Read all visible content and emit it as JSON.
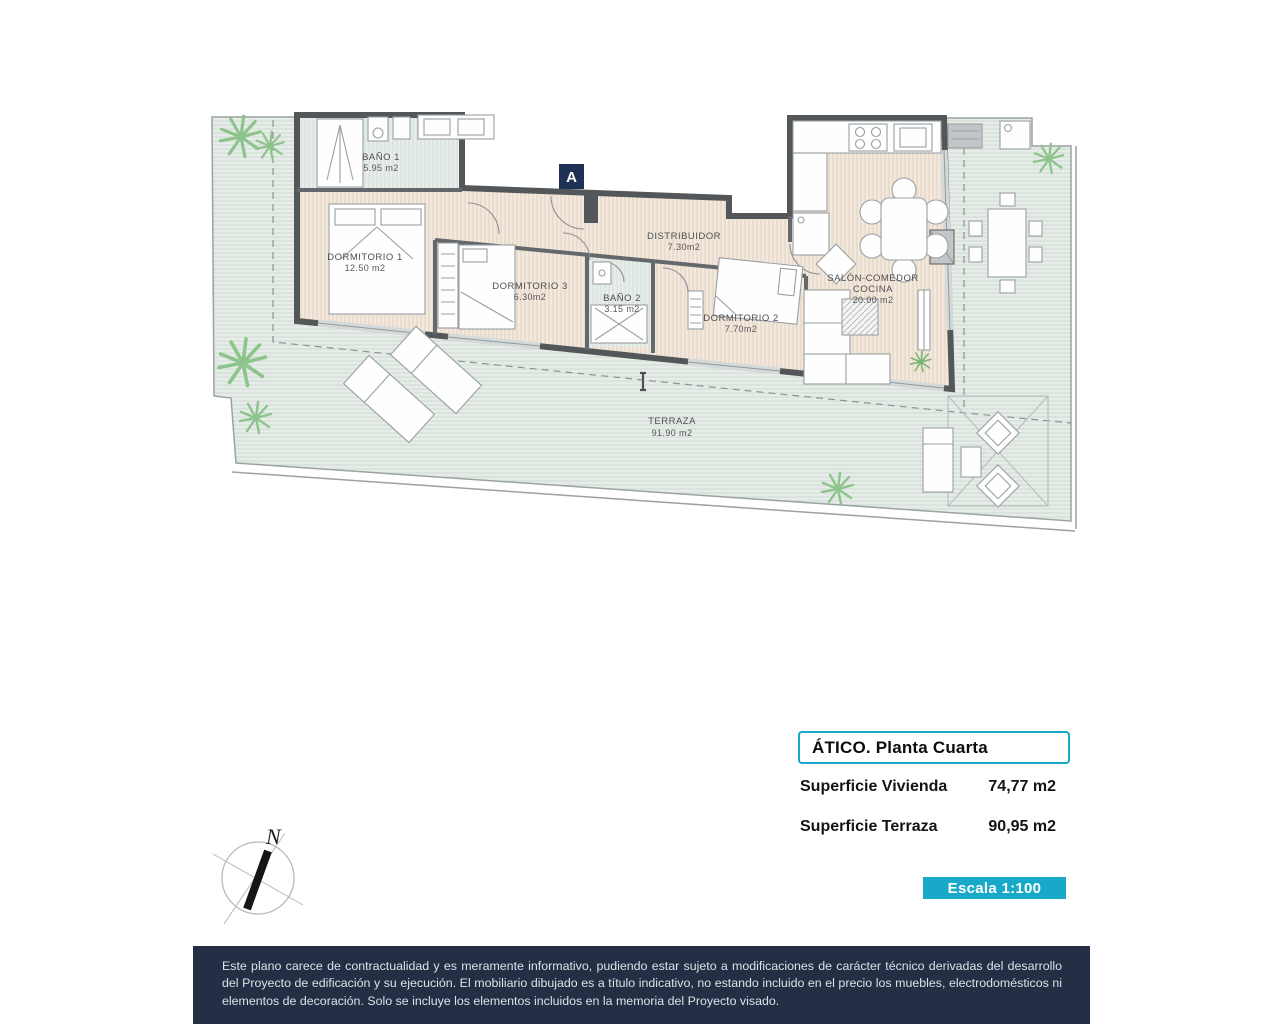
{
  "plan": {
    "section_marker": "A",
    "rooms": {
      "bano1": {
        "name": "BAÑO 1",
        "area": "5.95 m2"
      },
      "dorm1": {
        "name": "DORMITORIO 1",
        "area": "12.50 m2"
      },
      "dorm3": {
        "name": "DORMITORIO 3",
        "area": "6.30m2"
      },
      "bano2": {
        "name": "BAÑO 2",
        "area": "3.15 m2"
      },
      "distribuidor": {
        "name": "DISTRIBUIDOR",
        "area": "7.30m2"
      },
      "dorm2": {
        "name": "DORMITORIO 2",
        "area": "7.70m2"
      },
      "salon": {
        "name": "SALÓN-COMEDOR",
        "name2": "COCINA",
        "area": "20.00 m2"
      },
      "terraza": {
        "name": "TERRAZA",
        "area": "91.90 m2"
      }
    }
  },
  "info_panel": {
    "title": "ÁTICO. Planta Cuarta",
    "rows": [
      {
        "label": "Superficie Vivienda",
        "value": "74,77 m2"
      },
      {
        "label": "Superficie Terraza",
        "value": "90,95 m2"
      }
    ],
    "scale_badge": "Escala 1:100"
  },
  "compass": {
    "north_label": "N"
  },
  "footer": {
    "disclaimer": "Este plano carece de contractualidad y es meramente informativo, pudiendo estar sujeto a modificaciones de carácter técnico derivadas del desarrollo del Proyecto de edificación y su ejecución. El mobiliario dibujado es a título indicativo, no estando incluido en el precio los muebles, electrodomésticos ni elementos de decoración. Solo se incluye los elementos incluidos en la memoria del Proyecto visado."
  },
  "colors": {
    "accent_cyan": "#18a9c9",
    "marker_navy": "#1d3254",
    "footer_navy": "#242e45",
    "wall_gray": "#54575a",
    "terrace_tint": "#e6ece7",
    "wood_tint": "#f2e8dc",
    "palm_green": "#8cc48c"
  }
}
